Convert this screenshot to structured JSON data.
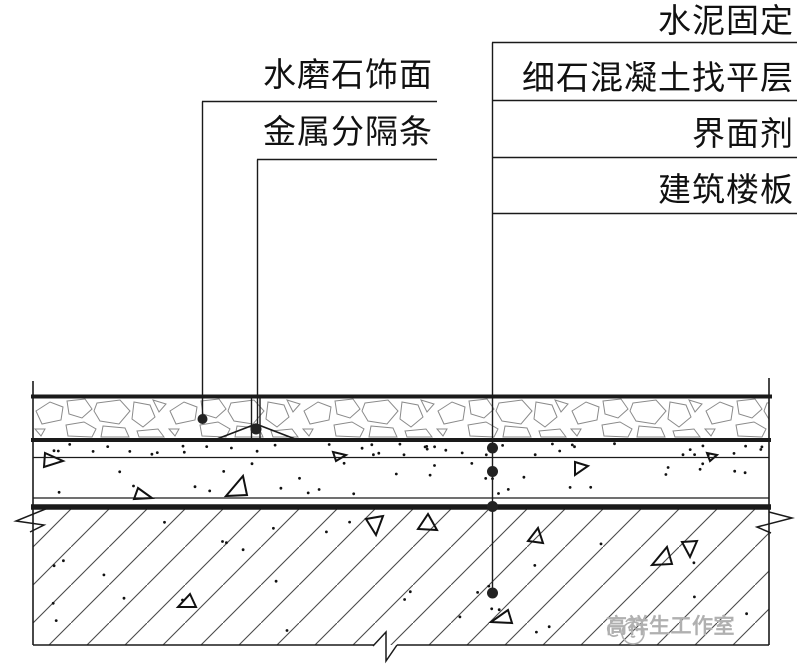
{
  "labels": {
    "left": [
      {
        "text": "水磨石饰面"
      },
      {
        "text": "金属分隔条"
      }
    ],
    "right": [
      {
        "text": "水泥固定"
      },
      {
        "text": "细石混凝土找平层"
      },
      {
        "text": "界面剂"
      },
      {
        "text": "建筑楼板"
      }
    ]
  },
  "watermark": {
    "text": "高祥生工作室"
  },
  "colors": {
    "line": "#1a1a1a",
    "stone_pattern": "#8a8a8a",
    "slab_hatch": "#4a4a4a",
    "watermark": "#b0b0b0"
  }
}
